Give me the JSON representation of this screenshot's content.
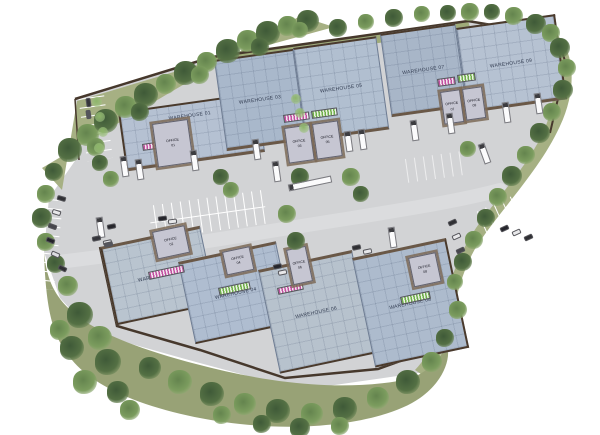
{
  "site": {
    "warehouses": [
      {
        "id": "01",
        "label": "WAREHOUSE 01"
      },
      {
        "id": "02",
        "label": "WAREHOUSE 02"
      },
      {
        "id": "03",
        "label": "WAREHOUSE 03"
      },
      {
        "id": "04",
        "label": "WAREHOUSE 04"
      },
      {
        "id": "05",
        "label": "WAREHOUSE 05"
      },
      {
        "id": "06",
        "label": "WAREHOUSE 06"
      },
      {
        "id": "07",
        "label": "WAREHOUSE 07"
      },
      {
        "id": "08",
        "label": "WAREHOUSE 08"
      },
      {
        "id": "09",
        "label": "WAREHOUSE 09"
      }
    ],
    "offices": [
      {
        "id": "01",
        "line1": "OFFICE",
        "line2": "01"
      },
      {
        "id": "02",
        "line1": "OFFICE",
        "line2": "02"
      },
      {
        "id": "03",
        "line1": "OFFICE",
        "line2": "03"
      },
      {
        "id": "04",
        "line1": "OFFICE",
        "line2": "04"
      },
      {
        "id": "05",
        "line1": "OFFICE",
        "line2": "05"
      },
      {
        "id": "06",
        "line1": "OFFICE",
        "line2": "06"
      },
      {
        "id": "07",
        "line1": "OFFICE",
        "line2": "07"
      },
      {
        "id": "08",
        "line1": "OFFICE",
        "line2": "08"
      },
      {
        "id": "09",
        "line1": "OFFICE",
        "line2": "09"
      }
    ],
    "colors": {
      "roof_blue": "#aeb9cc",
      "pavement_grey": "#d2d3d5",
      "grass_green": "#a6b083",
      "tree_green": "#4f6a42",
      "edging_brown": "#4a3a2c",
      "office_grey": "#c6c6d2",
      "canopy_pink": "#c250a0",
      "canopy_green": "#6fae4a"
    }
  }
}
